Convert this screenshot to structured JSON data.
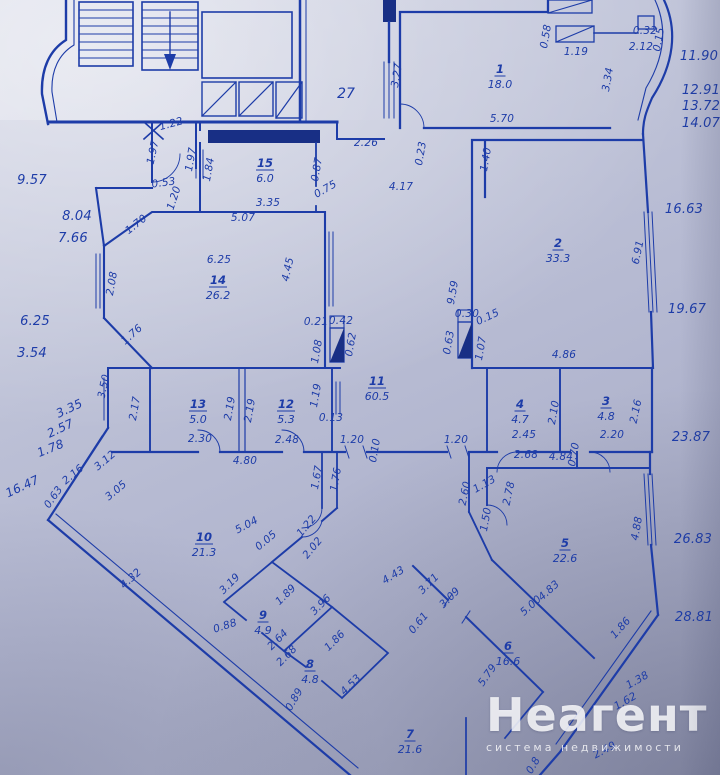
{
  "watermark": {
    "brand": "Неагент",
    "tagline": "система недвижимости"
  },
  "plan": {
    "ink_color": "#1d3ca8",
    "wall_fill_color": "#182f85",
    "paper_color": "#b7badt1",
    "zone_labels": [
      {
        "t": "27",
        "x": 346,
        "y": 98
      }
    ],
    "rooms": [
      {
        "num": "1",
        "area": "18.0",
        "x": 500,
        "y": 73
      },
      {
        "num": "2",
        "area": "33.3",
        "x": 558,
        "y": 247
      },
      {
        "num": "3",
        "area": "4.8",
        "x": 606,
        "y": 405
      },
      {
        "num": "4",
        "area": "4.7",
        "x": 520,
        "y": 408
      },
      {
        "num": "5",
        "area": "22.6",
        "x": 565,
        "y": 547
      },
      {
        "num": "6",
        "area": "16.6",
        "x": 508,
        "y": 650
      },
      {
        "num": "7",
        "area": "21.6",
        "x": 410,
        "y": 738
      },
      {
        "num": "8",
        "area": "4.8",
        "x": 310,
        "y": 668
      },
      {
        "num": "9",
        "area": "4.9",
        "x": 263,
        "y": 619
      },
      {
        "num": "10",
        "area": "21.3",
        "x": 204,
        "y": 541
      },
      {
        "num": "11",
        "area": "60.5",
        "x": 377,
        "y": 385
      },
      {
        "num": "12",
        "area": "5.3",
        "x": 286,
        "y": 408
      },
      {
        "num": "13",
        "area": "5.0",
        "x": 198,
        "y": 408
      },
      {
        "num": "14",
        "area": "26.2",
        "x": 218,
        "y": 284
      },
      {
        "num": "15",
        "area": "6.0",
        "x": 265,
        "y": 167
      }
    ],
    "dimensions": [
      {
        "t": "1.22",
        "x": 172,
        "y": 127,
        "r": -15
      },
      {
        "t": "1.97",
        "x": 156,
        "y": 153,
        "r": -78
      },
      {
        "t": "1.97",
        "x": 194,
        "y": 160,
        "r": -80
      },
      {
        "t": "1.84",
        "x": 212,
        "y": 170,
        "r": -80
      },
      {
        "t": "0.53",
        "x": 164,
        "y": 186,
        "r": -8
      },
      {
        "t": "1.20",
        "x": 177,
        "y": 199,
        "r": -72
      },
      {
        "t": "9.57",
        "x": 32,
        "y": 184,
        "r": 0,
        "s": 13
      },
      {
        "t": "0.87",
        "x": 320,
        "y": 170,
        "r": -80
      },
      {
        "t": "0.75",
        "x": 327,
        "y": 192,
        "r": -30
      },
      {
        "t": "3.35",
        "x": 268,
        "y": 206,
        "r": 0
      },
      {
        "t": "5.07",
        "x": 243,
        "y": 221,
        "r": 0
      },
      {
        "t": "2.26",
        "x": 366,
        "y": 146,
        "r": 0
      },
      {
        "t": "0.23",
        "x": 424,
        "y": 154,
        "r": -80
      },
      {
        "t": "4.17",
        "x": 401,
        "y": 190,
        "r": 0
      },
      {
        "t": "3.27",
        "x": 400,
        "y": 76,
        "r": -80
      },
      {
        "t": "5.70",
        "x": 502,
        "y": 122,
        "r": 0
      },
      {
        "t": "0.58",
        "x": 549,
        "y": 37,
        "r": -80
      },
      {
        "t": "1.19",
        "x": 576,
        "y": 55,
        "r": 0
      },
      {
        "t": "0.32",
        "x": 645,
        "y": 34,
        "r": 0
      },
      {
        "t": "2.12",
        "x": 641,
        "y": 50,
        "r": 0
      },
      {
        "t": "0.15",
        "x": 662,
        "y": 40,
        "r": -80
      },
      {
        "t": "3.34",
        "x": 611,
        "y": 80,
        "r": -80
      },
      {
        "t": "1.40",
        "x": 489,
        "y": 160,
        "r": -80
      },
      {
        "t": "11.90",
        "x": 699,
        "y": 60,
        "r": 0,
        "s": 13
      },
      {
        "t": "12.91",
        "x": 701,
        "y": 94,
        "r": 0,
        "s": 13
      },
      {
        "t": "13.72",
        "x": 701,
        "y": 110,
        "r": 0,
        "s": 13
      },
      {
        "t": "14.07",
        "x": 701,
        "y": 127,
        "r": 0,
        "s": 13
      },
      {
        "t": "8.04",
        "x": 77,
        "y": 220,
        "r": 0,
        "s": 13
      },
      {
        "t": "7.66",
        "x": 73,
        "y": 242,
        "r": 0,
        "s": 13
      },
      {
        "t": "1.70",
        "x": 138,
        "y": 227,
        "r": -38
      },
      {
        "t": "2.08",
        "x": 115,
        "y": 284,
        "r": -80
      },
      {
        "t": "6.25",
        "x": 219,
        "y": 263,
        "r": 0
      },
      {
        "t": "4.45",
        "x": 291,
        "y": 270,
        "r": -78
      },
      {
        "t": "6.25",
        "x": 35,
        "y": 325,
        "r": 0,
        "s": 13
      },
      {
        "t": "1.76",
        "x": 134,
        "y": 337,
        "r": -42
      },
      {
        "t": "3.54",
        "x": 32,
        "y": 357,
        "r": 0,
        "s": 13
      },
      {
        "t": "16.63",
        "x": 684,
        "y": 213,
        "r": 0,
        "s": 13
      },
      {
        "t": "6.91",
        "x": 641,
        "y": 253,
        "r": -78
      },
      {
        "t": "9.59",
        "x": 456,
        "y": 293,
        "r": -80
      },
      {
        "t": "19.67",
        "x": 687,
        "y": 313,
        "r": 0,
        "s": 13
      },
      {
        "t": "0.21",
        "x": 316,
        "y": 325,
        "r": 0
      },
      {
        "t": "0.42",
        "x": 341,
        "y": 324,
        "r": 0
      },
      {
        "t": "1.08",
        "x": 320,
        "y": 352,
        "r": -80
      },
      {
        "t": "0.62",
        "x": 354,
        "y": 345,
        "r": -80
      },
      {
        "t": "0.30",
        "x": 467,
        "y": 317,
        "r": 0
      },
      {
        "t": "0.15",
        "x": 489,
        "y": 320,
        "r": -25
      },
      {
        "t": "0.63",
        "x": 452,
        "y": 343,
        "r": -80
      },
      {
        "t": "1.07",
        "x": 484,
        "y": 349,
        "r": -80
      },
      {
        "t": "4.86",
        "x": 564,
        "y": 358,
        "r": 0
      },
      {
        "t": "3.50",
        "x": 107,
        "y": 387,
        "r": -78
      },
      {
        "t": "2.17",
        "x": 138,
        "y": 409,
        "r": -80
      },
      {
        "t": "2.19",
        "x": 233,
        "y": 409,
        "r": -80
      },
      {
        "t": "2.19",
        "x": 253,
        "y": 411,
        "r": -80
      },
      {
        "t": "1.19",
        "x": 319,
        "y": 396,
        "r": -80
      },
      {
        "t": "0.13",
        "x": 331,
        "y": 421,
        "r": 0
      },
      {
        "t": "2.30",
        "x": 200,
        "y": 442,
        "r": 0
      },
      {
        "t": "2.48",
        "x": 287,
        "y": 443,
        "r": 0
      },
      {
        "t": "1.20",
        "x": 352,
        "y": 443,
        "r": 0
      },
      {
        "t": "0.10",
        "x": 378,
        "y": 451,
        "r": -80
      },
      {
        "t": "4.80",
        "x": 245,
        "y": 464,
        "r": 0
      },
      {
        "t": "1.20",
        "x": 456,
        "y": 443,
        "r": 0
      },
      {
        "t": "3.35",
        "x": 71,
        "y": 412,
        "r": -25,
        "s": 12
      },
      {
        "t": "2.57",
        "x": 62,
        "y": 432,
        "r": -25,
        "s": 12
      },
      {
        "t": "1.78",
        "x": 52,
        "y": 452,
        "r": -22,
        "s": 12
      },
      {
        "t": "16.47",
        "x": 24,
        "y": 490,
        "r": -25,
        "s": 12
      },
      {
        "t": "2.45",
        "x": 524,
        "y": 438,
        "r": 0
      },
      {
        "t": "2.68",
        "x": 526,
        "y": 458,
        "r": 0
      },
      {
        "t": "4.84",
        "x": 561,
        "y": 460,
        "r": 0
      },
      {
        "t": "0.70",
        "x": 577,
        "y": 455,
        "r": -80
      },
      {
        "t": "2.10",
        "x": 557,
        "y": 413,
        "r": -80
      },
      {
        "t": "2.20",
        "x": 612,
        "y": 438,
        "r": 0
      },
      {
        "t": "2.16",
        "x": 639,
        "y": 412,
        "r": -78
      },
      {
        "t": "23.87",
        "x": 691,
        "y": 441,
        "r": 0,
        "s": 13
      },
      {
        "t": "2.60",
        "x": 468,
        "y": 494,
        "r": -78
      },
      {
        "t": "1.13",
        "x": 486,
        "y": 487,
        "r": -30
      },
      {
        "t": "2.78",
        "x": 512,
        "y": 494,
        "r": -78
      },
      {
        "t": "1.50",
        "x": 489,
        "y": 520,
        "r": -80
      },
      {
        "t": "0.63",
        "x": 56,
        "y": 499,
        "r": -55
      },
      {
        "t": "2.16",
        "x": 75,
        "y": 477,
        "r": -40
      },
      {
        "t": "3.12",
        "x": 107,
        "y": 463,
        "r": -40
      },
      {
        "t": "3.05",
        "x": 118,
        "y": 493,
        "r": -40
      },
      {
        "t": "5.04",
        "x": 248,
        "y": 528,
        "r": -28
      },
      {
        "t": "0.05",
        "x": 268,
        "y": 543,
        "r": -40
      },
      {
        "t": "1.22",
        "x": 309,
        "y": 528,
        "r": -50
      },
      {
        "t": "2.02",
        "x": 315,
        "y": 550,
        "r": -50
      },
      {
        "t": "1.67",
        "x": 320,
        "y": 478,
        "r": -80
      },
      {
        "t": "1.76",
        "x": 339,
        "y": 480,
        "r": -80
      },
      {
        "t": "4.32",
        "x": 133,
        "y": 581,
        "r": -42
      },
      {
        "t": "3.19",
        "x": 232,
        "y": 586,
        "r": -45
      },
      {
        "t": "1.89",
        "x": 288,
        "y": 597,
        "r": -45
      },
      {
        "t": "3.96",
        "x": 323,
        "y": 607,
        "r": -45
      },
      {
        "t": "4.43",
        "x": 395,
        "y": 578,
        "r": -32
      },
      {
        "t": "3.71",
        "x": 431,
        "y": 586,
        "r": -45
      },
      {
        "t": "3.09",
        "x": 452,
        "y": 600,
        "r": -45
      },
      {
        "t": "0.88",
        "x": 226,
        "y": 629,
        "r": -18
      },
      {
        "t": "2.64",
        "x": 280,
        "y": 642,
        "r": -45
      },
      {
        "t": "2.68",
        "x": 289,
        "y": 658,
        "r": -45
      },
      {
        "t": "1.86",
        "x": 337,
        "y": 643,
        "r": -45
      },
      {
        "t": "0.61",
        "x": 421,
        "y": 625,
        "r": -50
      },
      {
        "t": "0.89",
        "x": 297,
        "y": 701,
        "r": -60
      },
      {
        "t": "4.53",
        "x": 353,
        "y": 687,
        "r": -45
      },
      {
        "t": "5.79",
        "x": 490,
        "y": 677,
        "r": -55
      },
      {
        "t": "4.83",
        "x": 551,
        "y": 593,
        "r": -42
      },
      {
        "t": "5.00",
        "x": 533,
        "y": 608,
        "r": -42
      },
      {
        "t": "4.88",
        "x": 640,
        "y": 529,
        "r": -80
      },
      {
        "t": "26.83",
        "x": 693,
        "y": 543,
        "r": 0,
        "s": 13
      },
      {
        "t": "1.86",
        "x": 623,
        "y": 630,
        "r": -48
      },
      {
        "t": "28.81",
        "x": 694,
        "y": 621,
        "r": 0,
        "s": 13
      },
      {
        "t": "1.38",
        "x": 639,
        "y": 683,
        "r": -30
      },
      {
        "t": "1.62",
        "x": 627,
        "y": 704,
        "r": -30
      },
      {
        "t": "2.49",
        "x": 606,
        "y": 753,
        "r": -28
      },
      {
        "t": "0.8",
        "x": 536,
        "y": 767,
        "r": -60
      }
    ]
  }
}
